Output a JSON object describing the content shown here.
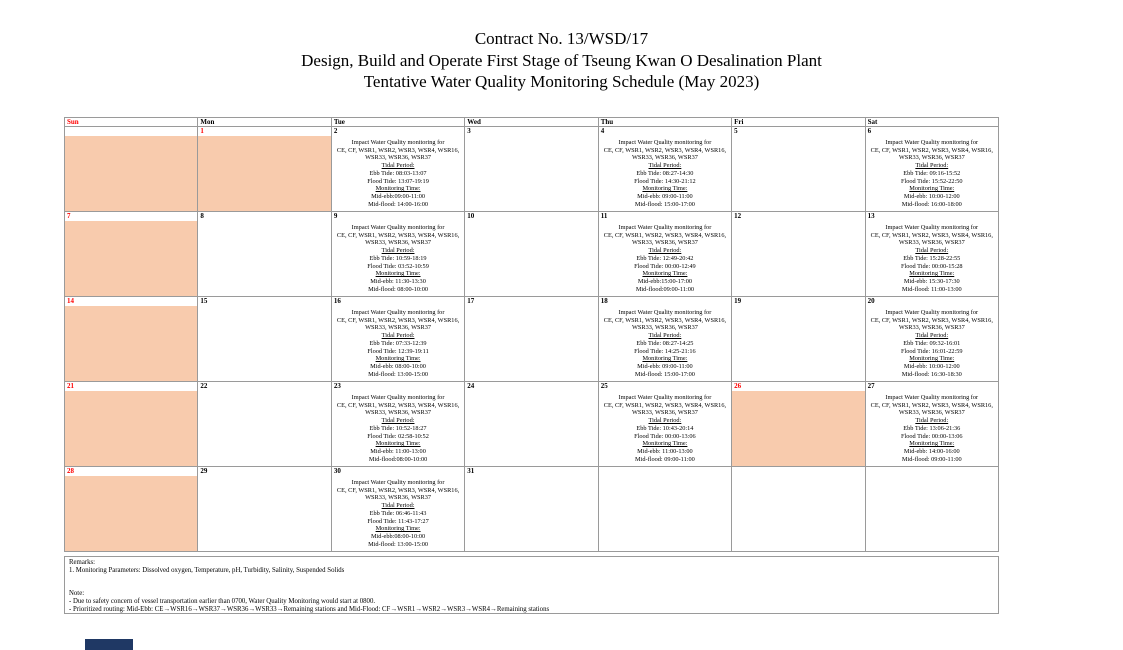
{
  "page": {
    "title_line1": "Contract No. 13/WSD/17",
    "title_line2": "Design, Build and Operate First Stage of Tseung Kwan O Desalination Plant",
    "title_line3": "Tentative Water Quality Monitoring Schedule (May 2023)"
  },
  "colors": {
    "holiday_fill": "#F8CBAD",
    "red_text": "#FF0000",
    "grid_line": "#9A9A9A",
    "navy_bar": "#1F3864"
  },
  "calendar": {
    "weekday_headers": [
      {
        "label": "Sun",
        "red": true
      },
      {
        "label": "Mon",
        "red": false
      },
      {
        "label": "Tue",
        "red": false
      },
      {
        "label": "Wed",
        "red": false
      },
      {
        "label": "Thu",
        "red": false
      },
      {
        "label": "Fri",
        "red": false
      },
      {
        "label": "Sat",
        "red": false
      }
    ],
    "event_common_lines": [
      "Impact Water Quality monitoring for",
      "CE, CF, WSR1, WSR2, WSR3, WSR4, WSR16,",
      "WSR33, WSR36, WSR37"
    ],
    "tidal_period_label": "Tidal Period:",
    "monitoring_time_label": "Monitoring Time:",
    "weeks": [
      {
        "days": [
          {
            "num": "",
            "shaded": true
          },
          {
            "num": "1",
            "red": true,
            "shaded": true
          },
          {
            "num": "2",
            "event": {
              "ebb": "Ebb Tide: 08:03-13:07",
              "flood": "Flood Tide: 13:07-19:19",
              "mid_ebb": "Mid-ebb:09:00-11:00",
              "mid_flood": "Mid-flood: 14:00-16:00"
            }
          },
          {
            "num": "3"
          },
          {
            "num": "4",
            "event": {
              "ebb": "Ebb Tide: 08:27-14:30",
              "flood": "Flood Tide: 14:30-21:12",
              "mid_ebb": "Mid-ebb: 09:00-11:00",
              "mid_flood": "Mid-flood: 15:00-17:00"
            }
          },
          {
            "num": "5"
          },
          {
            "num": "6",
            "event": {
              "ebb": "Ebb Tide: 09:16-15:52",
              "flood": "Flood Tide: 15:52-22:50",
              "mid_ebb": "Mid-ebb: 10:00-12:00",
              "mid_flood": "Mid-flood: 16:00-18:00"
            }
          }
        ]
      },
      {
        "days": [
          {
            "num": "7",
            "red": true,
            "shaded": true
          },
          {
            "num": "8"
          },
          {
            "num": "9",
            "event": {
              "ebb": "Ebb Tide: 10:59-18:19",
              "flood": "Flood Tide: 03:52-10:59",
              "mid_ebb": "Mid-ebb: 11:30-13:30",
              "mid_flood": "Mid-flood: 08:00-10:00"
            }
          },
          {
            "num": "10"
          },
          {
            "num": "11",
            "event": {
              "ebb": "Ebb Tide: 12:49-20:42",
              "flood": "Flood Tide: 00:00-12:49",
              "mid_ebb": "Mid-ebb:15:00-17:00",
              "mid_flood": "Mid-flood:09:00-11:00"
            }
          },
          {
            "num": "12"
          },
          {
            "num": "13",
            "event": {
              "ebb": "Ebb Tide: 15:28-22:55",
              "flood": "Flood Tide: 00:00-15:28",
              "mid_ebb": "Mid-ebb: 15:30-17:30",
              "mid_flood": "Mid-flood: 11:00-13:00"
            }
          }
        ]
      },
      {
        "days": [
          {
            "num": "14",
            "red": true,
            "shaded": true
          },
          {
            "num": "15"
          },
          {
            "num": "16",
            "event": {
              "ebb": "Ebb Tide: 07:33-12:39",
              "flood": "Flood Tide: 12:39-19:11",
              "mid_ebb": "Mid-ebb: 08:00-10:00",
              "mid_flood": "Mid-flood: 13:00-15:00"
            }
          },
          {
            "num": "17"
          },
          {
            "num": "18",
            "event": {
              "ebb": "Ebb Tide: 08:27-14:25",
              "flood": "Flood Tide: 14:25-21:16",
              "mid_ebb": "Mid-ebb: 09:00-11:00",
              "mid_flood": "Mid-flood: 15:00-17:00"
            }
          },
          {
            "num": "19"
          },
          {
            "num": "20",
            "event": {
              "ebb": "Ebb Tide: 09:32-16:01",
              "flood": "Flood Tide: 16:01-22:59",
              "mid_ebb": "Mid-ebb: 10:00-12:00",
              "mid_flood": "Mid-flood: 16:30-18:30"
            }
          }
        ]
      },
      {
        "days": [
          {
            "num": "21",
            "red": true,
            "shaded": true
          },
          {
            "num": "22"
          },
          {
            "num": "23",
            "event": {
              "ebb": "Ebb Tide: 10:52-18:27",
              "flood": "Flood Tide: 02:58-10:52",
              "mid_ebb": "Mid-ebb: 11:00-13:00",
              "mid_flood": "Mid-flood:08:00-10:00"
            }
          },
          {
            "num": "24"
          },
          {
            "num": "25",
            "event": {
              "ebb": "Ebb Tide: 10:43-20:14",
              "flood": "Flood Tide: 00:00-13:06",
              "mid_ebb": "Mid-ebb: 11:00-13:00",
              "mid_flood": "Mid-flood: 09:00-11:00"
            }
          },
          {
            "num": "26",
            "red": true,
            "shaded": true
          },
          {
            "num": "27",
            "event": {
              "ebb": "Ebb Tide: 13:06-21:36",
              "flood": "Flood Tide: 00:00-13:06",
              "mid_ebb": "Mid-ebb: 14:00-16:00",
              "mid_flood": "Mid-flood: 09:00-11:00"
            }
          }
        ]
      },
      {
        "days": [
          {
            "num": "28",
            "red": true,
            "shaded": true
          },
          {
            "num": "29"
          },
          {
            "num": "30",
            "event": {
              "ebb": "Ebb Tide: 06:46-11:43",
              "flood": "Flood Tide: 11:43-17:27",
              "mid_ebb": "Mid-ebb:08:00-10:00",
              "mid_flood": "Mid-flood: 13:00-15:00"
            }
          },
          {
            "num": "31"
          },
          {
            "num": ""
          },
          {
            "num": ""
          },
          {
            "num": ""
          }
        ]
      }
    ]
  },
  "remarks": {
    "heading": "Remarks:",
    "line1": "1. Monitoring Parameters: Dissolved oxygen, Temperature, pH, Turbidity, Salinity, Suspended Solids",
    "note_heading": "Note:",
    "note_line1": "- Due to safety concern of vessel transportation earlier than 0700, Water Quality Monitoring would start at 0800.",
    "note_line2": "- Prioritized routing: Mid-Ebb: CE→WSR16→WSR37→WSR36→WSR33→Remaining stations and Mid-Flood: CF→WSR1→WSR2→WSR3→WSR4→Remaining stations"
  }
}
